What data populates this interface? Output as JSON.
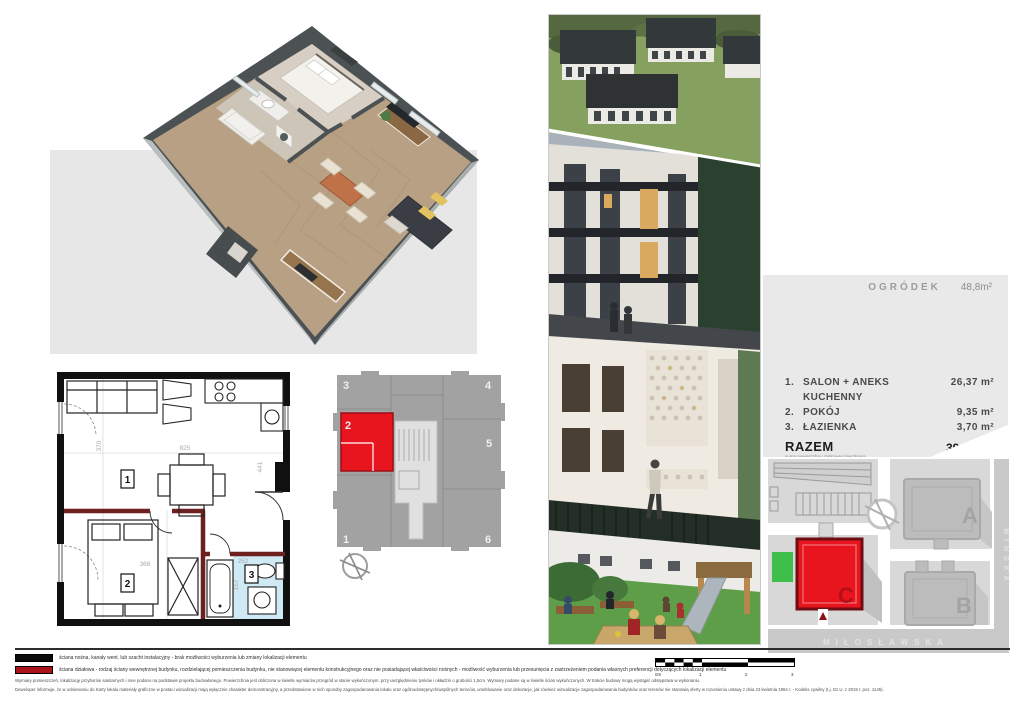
{
  "panel": {
    "garden_label": "OGRÓDEK",
    "garden_value": "48,8m²",
    "rooms": [
      {
        "no": "1.",
        "name": "SALON + ANEKS KUCHENNY",
        "area": "26,37 m²"
      },
      {
        "no": "2.",
        "name": "POKÓJ",
        "area": "9,35 m²"
      },
      {
        "no": "3.",
        "name": "ŁAZIENKA",
        "area": "3,70 m²"
      }
    ],
    "total_label": "RAZEM",
    "total_sub": "suma powierzchni użytkowej mieszkania",
    "total_value": "39,42 m²"
  },
  "site_map": {
    "buildings": [
      "A",
      "B",
      "C"
    ],
    "street_bottom": "MIŁOSŁAWSKA",
    "street_right": "MIŃSKA",
    "highlight_color": "#e8141e",
    "green_color": "#3fbf49"
  },
  "key_plan": {
    "units": [
      "3",
      "4",
      "2",
      "5",
      "1",
      "6"
    ],
    "highlighted_unit": "2"
  },
  "floor_plan": {
    "room_numbers": [
      "1",
      "2",
      "3"
    ],
    "dimensions": [
      "825",
      "441",
      "370",
      "368",
      "252",
      "157"
    ],
    "bathroom_color": "#cfe9f5",
    "partition_color": "#6e1f1f"
  },
  "legend": {
    "black_label": "ściana nośna, kanały went. lub szacht instalacyjny - brak możliwości wyburzenia lub zmiany lokalizacji elementu",
    "red_label": "ściana działowa - rodzaj ściany wewnętrznej budynku, rozdzielającej pomieszczenia budynku, nie stanowiącej elementu konstrukcyjnego oraz nie posiadającej właściwości nośnych - możliwość wyburzenia lub przesunięcia z zastrzeżeniem podania własnych preferencji dotyczących lokalizacji elementu",
    "disclaimer_1": "Wymiary pomieszczeń, lokalizację przyborów sanitarnych i inne podano na podstawie projektu budowlanego. Powierzchnia jest obliczona w świetle wymiarów przegród w stanie wykończonym, przy uwzględnieniu tynków i okładzin o grubości 1,5cm. Wymiary podane są w świetle ścian wykończonych. W trakcie budowy mogą wystąpić odstępstwa w wykonaniu.",
    "disclaimer_2": "Deweloper informuje, że w odniesieniu do Karty lokalu materiały graficzne w postaci wizualizacji mają wyłącznie charakter demonstracyjny, a przedstawione w nich sposoby zagospodarowania lokalu oraz ogólnodostępnych/wspólnych terenów, umeblowanie oraz dekoracje, jak również wizualizacje zagospodarowania budynków oraz terenów nie stanowią oferty w rozumieniu ustawy z dnia 23 kwietnia 1964 r. - Kodeks cywilny (t.j. Dz.U. z 2019 r. poz. 1145).",
    "scale_ticks": [
      "0m",
      "1",
      "2",
      "3"
    ]
  }
}
